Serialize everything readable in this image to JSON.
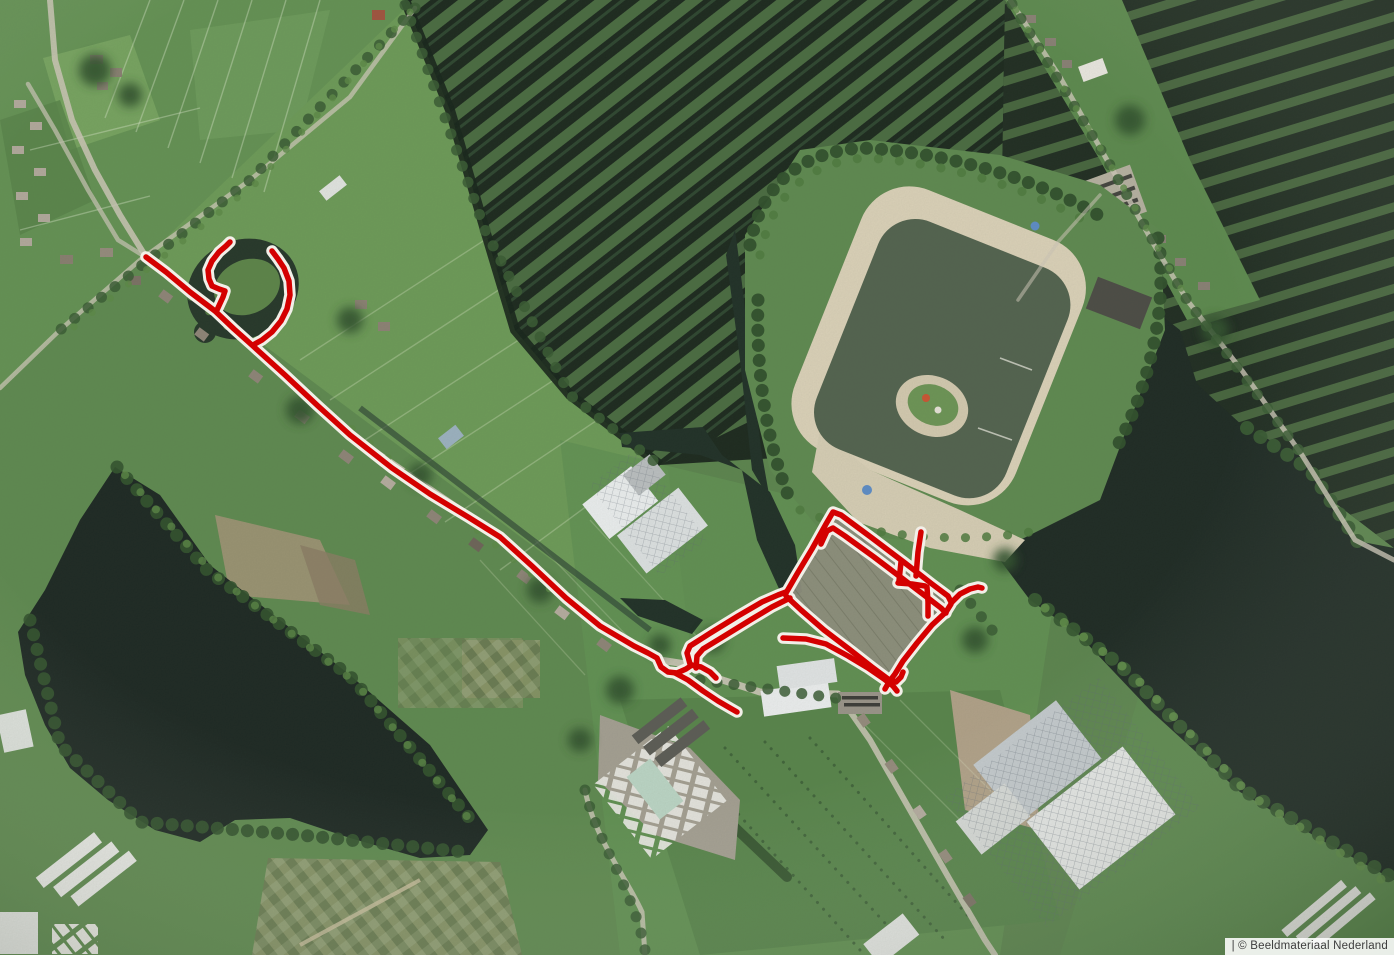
{
  "attribution": {
    "text": "| © Beeldmateriaal Nederland"
  },
  "map": {
    "type": "aerial-imagery",
    "provider_label": "Beeldmateriaal Nederland",
    "colors": {
      "route_red": "#d40000",
      "route_casing": "#f2efe8",
      "field_green": "#679556",
      "wetland_dark": "#1c291e",
      "lake_dark": "#1e2a24",
      "swim_lake": "#53634f",
      "sand": "#ddd3ba",
      "road_light": "#cfc9ba"
    }
  },
  "route": {
    "stroke": "#d40000",
    "casing": "#f2efe8",
    "width": 5.5,
    "casing_width": 11.5,
    "paths": [
      {
        "name": "main-street",
        "points": [
          [
            146,
            257
          ],
          [
            166,
            272
          ],
          [
            190,
            292
          ],
          [
            215,
            311
          ],
          [
            234,
            329
          ],
          [
            253,
            346
          ],
          [
            285,
            375
          ],
          [
            318,
            406
          ],
          [
            350,
            435
          ],
          [
            392,
            468
          ],
          [
            430,
            494
          ],
          [
            468,
            517
          ],
          [
            500,
            537
          ],
          [
            532,
            566
          ],
          [
            566,
            598
          ],
          [
            600,
            626
          ],
          [
            634,
            646
          ],
          [
            648,
            653
          ],
          [
            657,
            658
          ],
          [
            661,
            667
          ],
          [
            668,
            672
          ],
          [
            677,
            673
          ],
          [
            686,
            669
          ],
          [
            692,
            665
          ]
        ]
      },
      {
        "name": "pond-loop-west",
        "points": [
          [
            217,
            310
          ],
          [
            223,
            297
          ],
          [
            225,
            291
          ],
          [
            219,
            289
          ],
          [
            212,
            286
          ],
          [
            209,
            279
          ],
          [
            208,
            270
          ],
          [
            212,
            261
          ],
          [
            219,
            252
          ],
          [
            226,
            246
          ],
          [
            230,
            242
          ]
        ]
      },
      {
        "name": "pond-loop-east",
        "points": [
          [
            253,
            345
          ],
          [
            262,
            340
          ],
          [
            272,
            332
          ],
          [
            281,
            321
          ],
          [
            287,
            309
          ],
          [
            290,
            295
          ],
          [
            289,
            281
          ],
          [
            284,
            268
          ],
          [
            278,
            259
          ],
          [
            272,
            251
          ]
        ]
      },
      {
        "name": "junction-spur-east",
        "points": [
          [
            691,
            665
          ],
          [
            701,
            667
          ],
          [
            710,
            672
          ],
          [
            716,
            678
          ]
        ]
      },
      {
        "name": "junction-spur-southeast",
        "points": [
          [
            675,
            673
          ],
          [
            688,
            680
          ],
          [
            703,
            691
          ],
          [
            718,
            701
          ],
          [
            730,
            708
          ],
          [
            737,
            712
          ]
        ]
      },
      {
        "name": "access-lane-north",
        "points": [
          [
            690,
            664
          ],
          [
            687,
            653
          ],
          [
            690,
            646
          ],
          [
            712,
            632
          ],
          [
            738,
            616
          ],
          [
            762,
            602
          ],
          [
            778,
            595
          ],
          [
            786,
            592
          ]
        ]
      },
      {
        "name": "access-lane-south",
        "points": [
          [
            696,
            668
          ],
          [
            697,
            656
          ],
          [
            703,
            649
          ],
          [
            726,
            635
          ],
          [
            752,
            619
          ],
          [
            772,
            607
          ],
          [
            784,
            601
          ],
          [
            790,
            598
          ]
        ]
      },
      {
        "name": "loop-northwest",
        "points": [
          [
            786,
            593
          ],
          [
            797,
            574
          ],
          [
            812,
            549
          ],
          [
            826,
            524
          ],
          [
            833,
            512
          ],
          [
            841,
            515
          ],
          [
            872,
            538
          ],
          [
            905,
            563
          ],
          [
            932,
            584
          ],
          [
            948,
            596
          ],
          [
            951,
            602
          ]
        ]
      },
      {
        "name": "loop-east",
        "points": [
          [
            951,
            604
          ],
          [
            946,
            612
          ],
          [
            932,
            625
          ],
          [
            917,
            643
          ],
          [
            903,
            661
          ],
          [
            895,
            674
          ],
          [
            889,
            682
          ],
          [
            885,
            689
          ]
        ]
      },
      {
        "name": "loop-south",
        "points": [
          [
            786,
            596
          ],
          [
            801,
            610
          ],
          [
            824,
            630
          ],
          [
            849,
            649
          ],
          [
            872,
            667
          ],
          [
            888,
            679
          ],
          [
            896,
            682
          ],
          [
            901,
            677
          ],
          [
            903,
            672
          ]
        ]
      },
      {
        "name": "loop-inner",
        "points": [
          [
            821,
            544
          ],
          [
            827,
            531
          ],
          [
            833,
            528
          ],
          [
            845,
            536
          ],
          [
            874,
            557
          ],
          [
            903,
            579
          ],
          [
            928,
            598
          ],
          [
            941,
            608
          ],
          [
            946,
            613
          ]
        ]
      },
      {
        "name": "cross-street-north",
        "points": [
          [
            921,
            532
          ],
          [
            918,
            552
          ],
          [
            916,
            576
          ]
        ]
      },
      {
        "name": "cross-street-west",
        "points": [
          [
            901,
            562
          ],
          [
            899,
            581
          ]
        ]
      },
      {
        "name": "cross-street-link",
        "points": [
          [
            898,
            583
          ],
          [
            912,
            584
          ],
          [
            925,
            586
          ]
        ]
      },
      {
        "name": "cross-street-east",
        "points": [
          [
            927,
            587
          ],
          [
            928,
            602
          ],
          [
            928,
            616
          ]
        ]
      },
      {
        "name": "spur-far-east",
        "points": [
          [
            952,
            602
          ],
          [
            960,
            594
          ],
          [
            970,
            589
          ],
          [
            978,
            587
          ],
          [
            982,
            588
          ]
        ]
      },
      {
        "name": "south-lane",
        "points": [
          [
            783,
            638
          ],
          [
            806,
            639
          ],
          [
            826,
            644
          ],
          [
            848,
            656
          ],
          [
            868,
            668
          ],
          [
            884,
            679
          ],
          [
            893,
            686
          ],
          [
            897,
            691
          ]
        ]
      }
    ]
  }
}
